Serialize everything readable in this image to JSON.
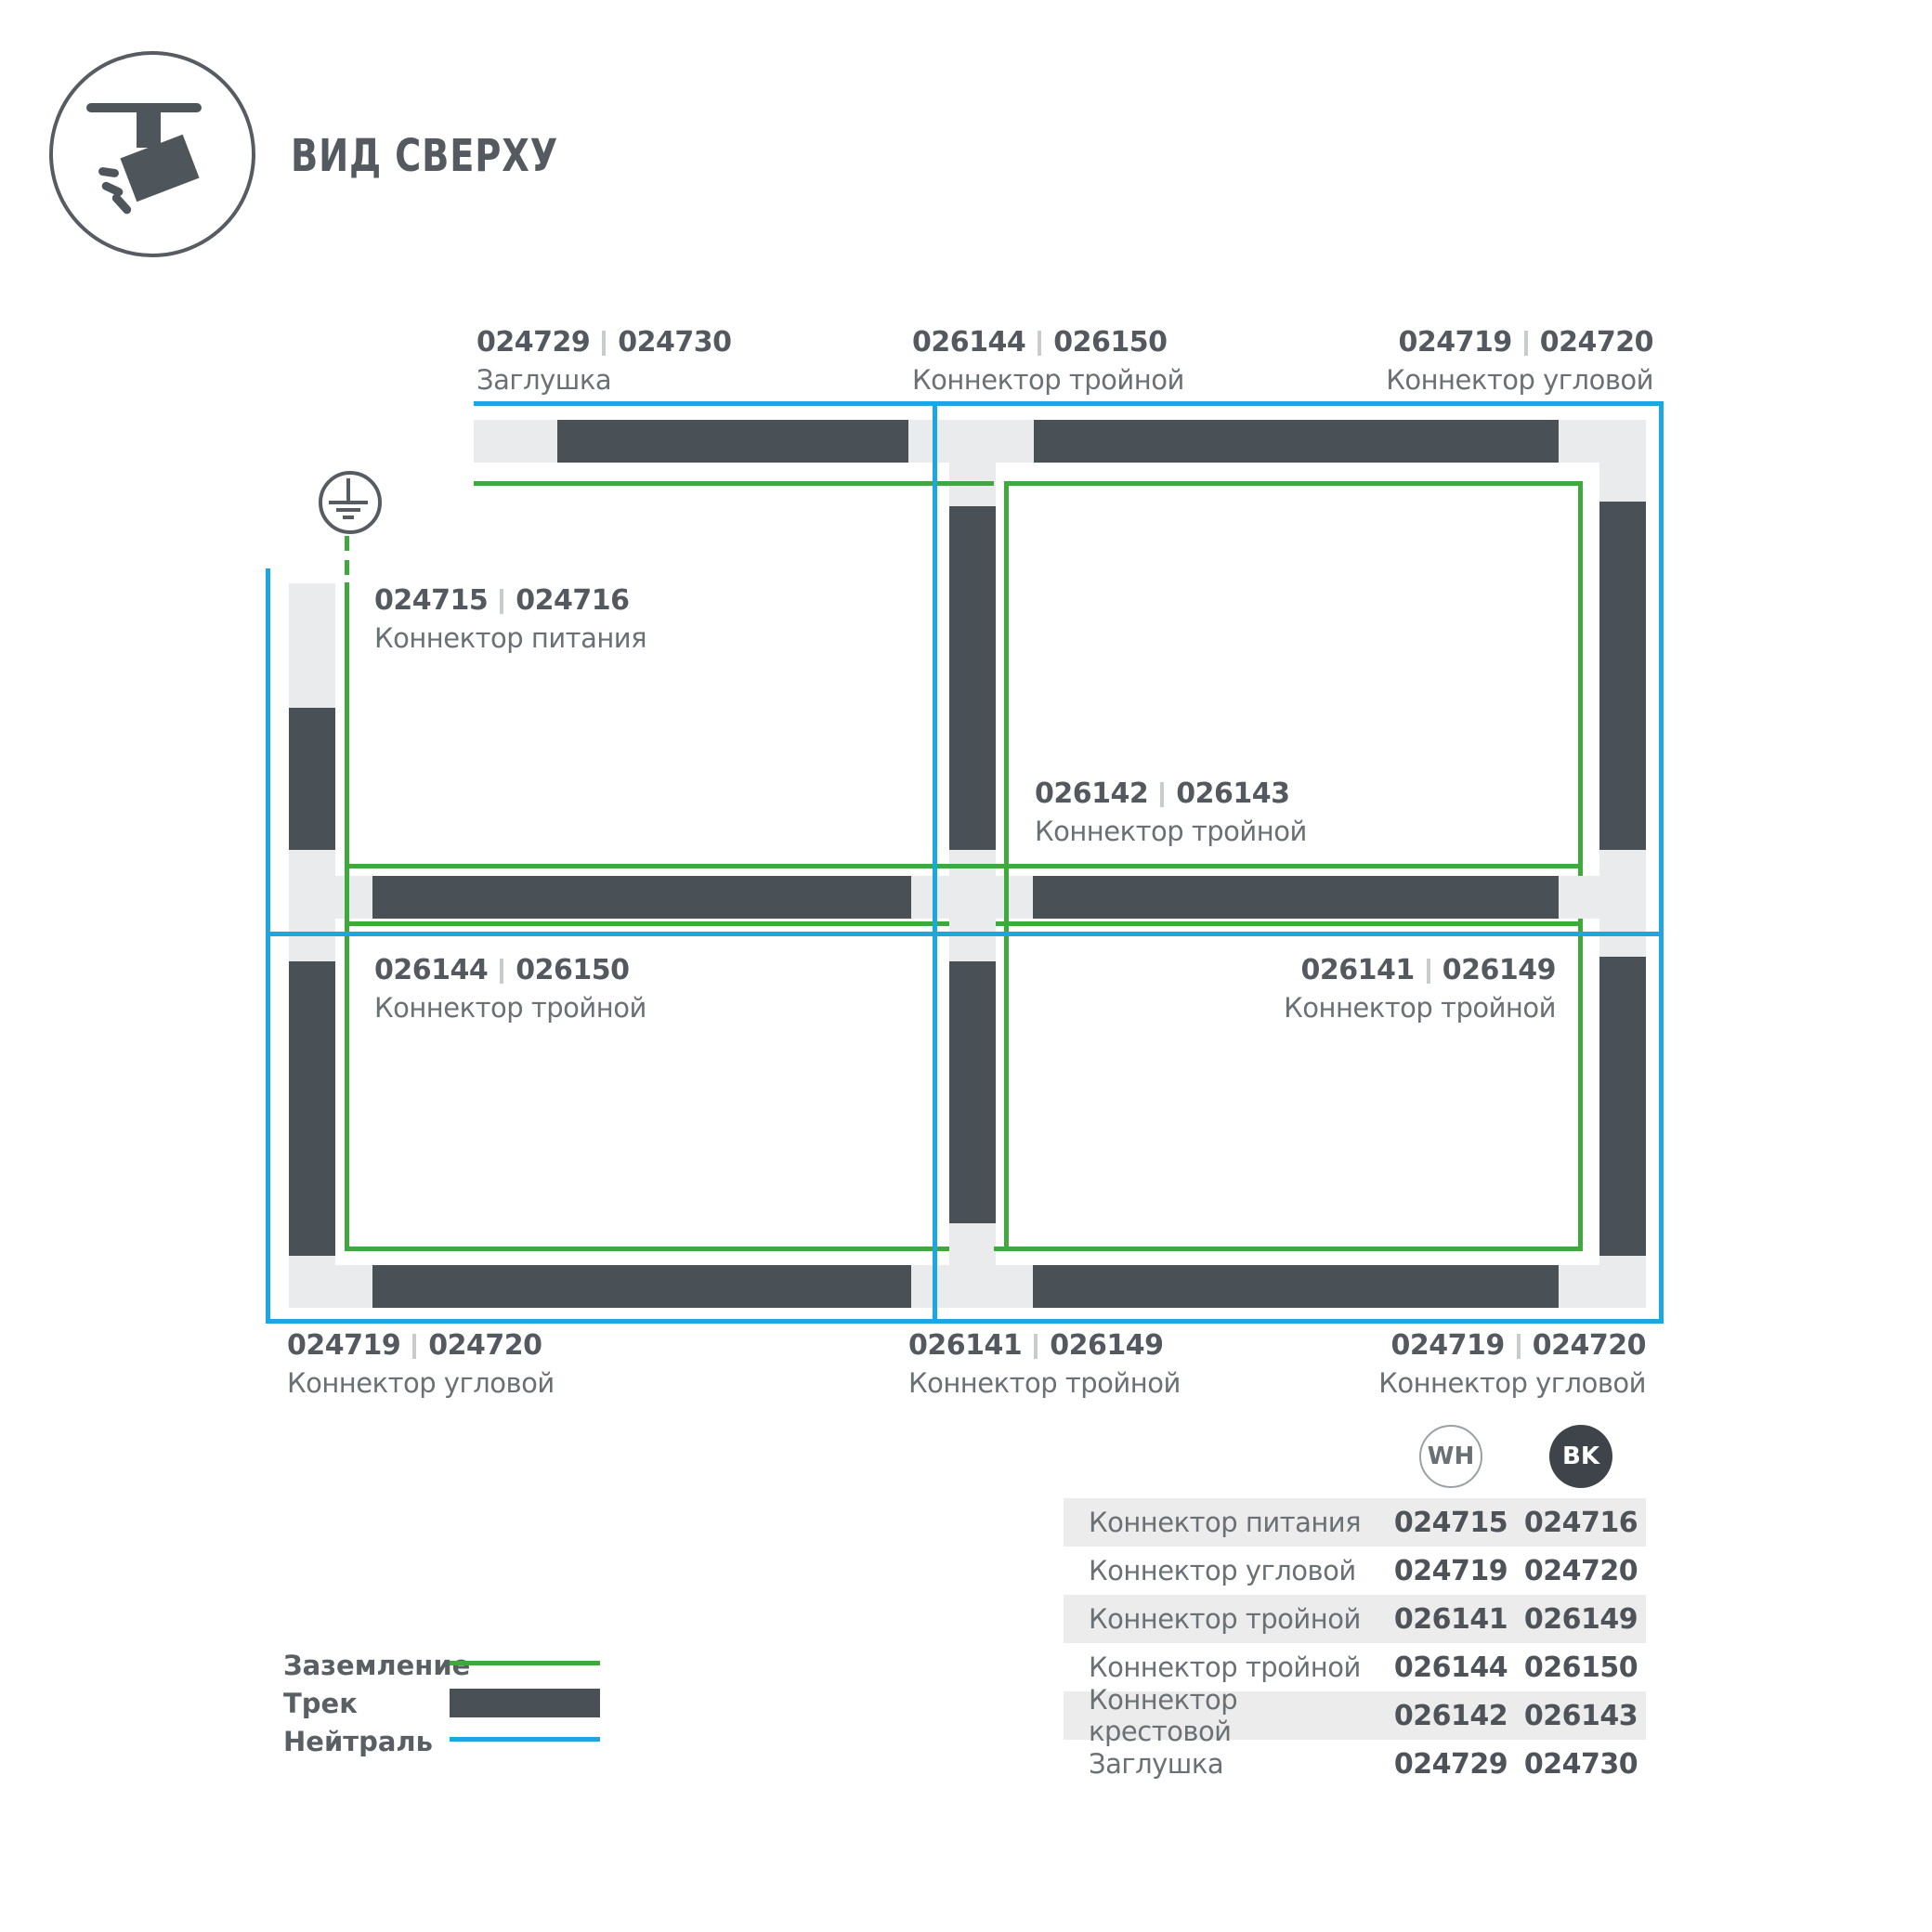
{
  "title": "ВИД СВЕРХУ",
  "colors": {
    "track": "#4a5156",
    "track_connector": "#e9ebec",
    "ground_wire": "#3faa3c",
    "neutral_wire": "#1ea6e0",
    "text_dark": "#53595e",
    "text_regular": "#6a7074",
    "badge_bk_fill": "#3e444a"
  },
  "diagram_labels": [
    {
      "wh": "024729",
      "bk": "024730",
      "name": "Заглушка"
    },
    {
      "wh": "026144",
      "bk": "026150",
      "name": "Коннектор тройной"
    },
    {
      "wh": "024719",
      "bk": "024720",
      "name": "Коннектор угловой"
    },
    {
      "wh": "024715",
      "bk": "024716",
      "name": "Коннектор питания"
    },
    {
      "wh": "026142",
      "bk": "026143",
      "name": "Коннектор тройной"
    },
    {
      "wh": "026144",
      "bk": "026150",
      "name": "Коннектор тройной"
    },
    {
      "wh": "026141",
      "bk": "026149",
      "name": "Коннектор тройной"
    },
    {
      "wh": "024719",
      "bk": "024720",
      "name": "Коннектор угловой"
    },
    {
      "wh": "026141",
      "bk": "026149",
      "name": "Коннектор тройной"
    },
    {
      "wh": "024719",
      "bk": "024720",
      "name": "Коннектор угловой"
    }
  ],
  "legend": {
    "items": [
      {
        "label": "Заземление",
        "swatch": "ground-line"
      },
      {
        "label": "Трек",
        "swatch": "track-bar"
      },
      {
        "label": "Нейтраль",
        "swatch": "neutral-line"
      }
    ]
  },
  "badges": {
    "wh": "WH",
    "bk": "BK"
  },
  "table": {
    "rows": [
      {
        "name": "Коннектор питания",
        "wh": "024715",
        "bk": "024716"
      },
      {
        "name": "Коннектор угловой",
        "wh": "024719",
        "bk": "024720"
      },
      {
        "name": "Коннектор тройной",
        "wh": "026141",
        "bk": "026149"
      },
      {
        "name": "Коннектор тройной",
        "wh": "026144",
        "bk": "026150"
      },
      {
        "name": "Коннектор крестовой",
        "wh": "026142",
        "bk": "026143"
      },
      {
        "name": "Заглушка",
        "wh": "024729",
        "bk": "024730"
      }
    ]
  }
}
